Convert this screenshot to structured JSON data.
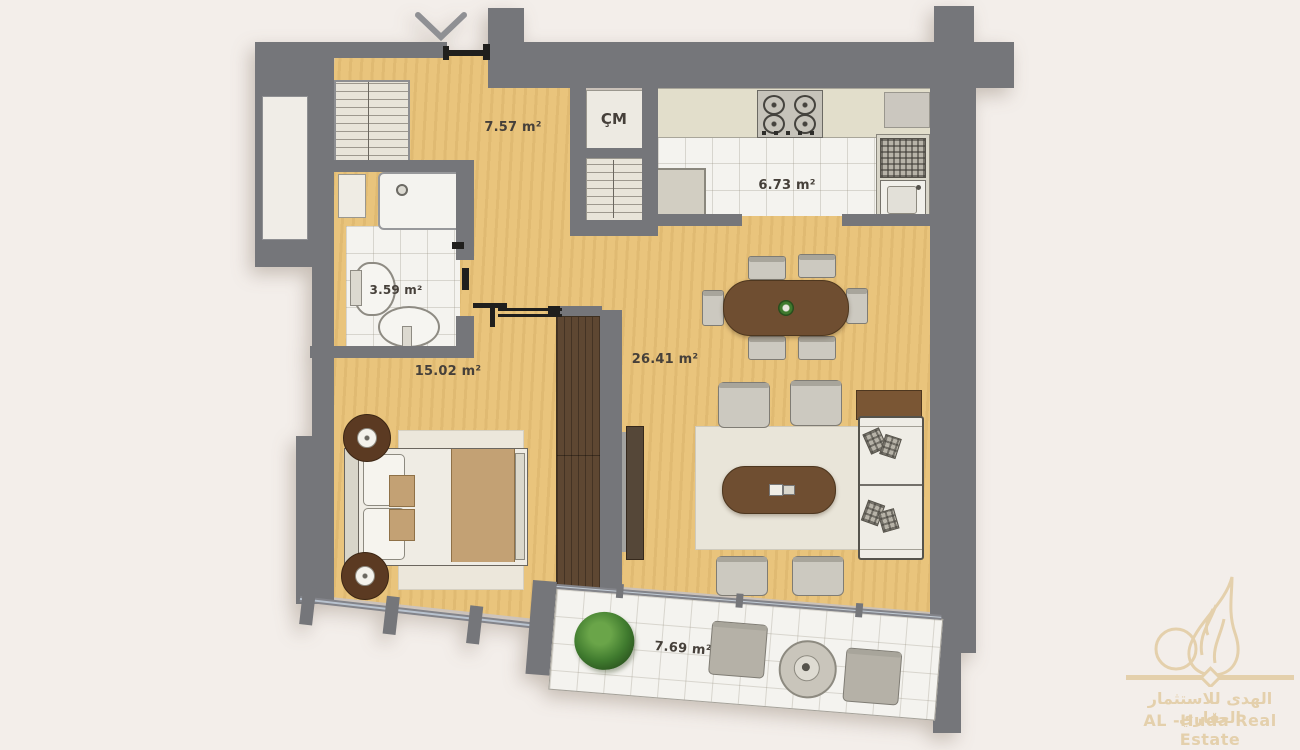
{
  "plan_title": "apartment-floor-plan",
  "rooms": {
    "hall": {
      "area": "7.57 m²"
    },
    "kitchen": {
      "area": "6.73 m²"
    },
    "bathroom": {
      "area": "3.59 m²"
    },
    "bedroom": {
      "area": "15.02 m²"
    },
    "living": {
      "area": "26.41 m²"
    },
    "balcony": {
      "area": "7.69 m²"
    },
    "laundry_closet": {
      "label": "ÇM"
    }
  },
  "watermark": {
    "arabic": "الهدى للاستثمار العقاري",
    "english": "AL -Huda Real Estate"
  },
  "colors": {
    "background": "#f3eeea",
    "wall": "#75767a",
    "wood_floor": "#e9c47c",
    "tile_floor": "#f4f3ef",
    "counter": "#e2decb",
    "dark_wood_furniture": "#6f4e31",
    "wardrobe": "#5e4732",
    "rug": "#e9e5d9",
    "logo_gold": "#e3cda6",
    "plant_green": "#3f7a2e"
  }
}
